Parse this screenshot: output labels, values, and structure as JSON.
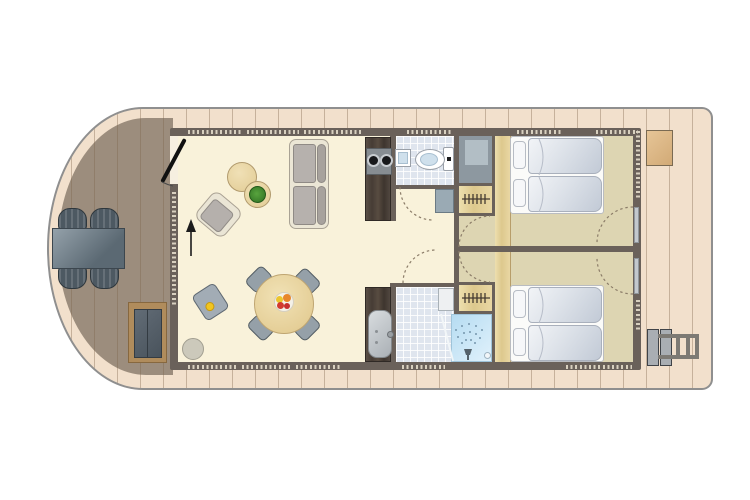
{
  "meta": {
    "title": "Houseboat floor plan (top view)",
    "kind": "architectural-floor-plan",
    "text_visible": "none"
  },
  "palette": {
    "hull": "#f2e0cc",
    "deck_plank_line": "#7d644b",
    "bow_terrace": "#9c8d7d",
    "wall": "#6a615a",
    "living_floor": "#f9f2da",
    "bedroom_floor": "#ddd5b2",
    "tile_floor": "#dfe5ee",
    "light_wood": "#e9d7a3",
    "dark_wood_counter": "#4d433c",
    "shower_blue": "#bfe0f3",
    "plant_green": "#3e8d2d",
    "furniture_slate": "#5b6973"
  },
  "rooms": [
    {
      "id": "bow-terrace",
      "name": "Bow terrace deck"
    },
    {
      "id": "living-room",
      "name": "Living room with lounge and dining area"
    },
    {
      "id": "kitchen",
      "name": "Kitchenette with 2-burner hob"
    },
    {
      "id": "toilet-room",
      "name": "Toilet room with corner hand basin"
    },
    {
      "id": "hallway",
      "name": "Central hallway"
    },
    {
      "id": "bathroom",
      "name": "Bathroom with vanity and walk-in shower"
    },
    {
      "id": "technical-room",
      "name": "Technical / storage room"
    },
    {
      "id": "bedroom-top",
      "name": "Bedroom 1 with two single beds and wardrobe"
    },
    {
      "id": "bedroom-bottom",
      "name": "Bedroom 2 with two single beds and wardrobe"
    },
    {
      "id": "stern-deck",
      "name": "Stern deck with storage box and swim ladder"
    }
  ],
  "furniture": [
    "outdoor dining table",
    "four outdoor chairs",
    "outdoor storage bench",
    "entrance door with swing",
    "entry direction arrow",
    "sofa",
    "armchair",
    "two round side tables",
    "potted plant",
    "round dining table with fruit bowl",
    "four dining chairs",
    "child high chair",
    "pouf",
    "kitchen counter",
    "two-burner cooktop",
    "corner hand basin",
    "toilet",
    "hall cabinet",
    "washbasin on vanity",
    "white appliance",
    "walk-in shower with rain head",
    "two wardrobes with hanging rails",
    "four single beds with pillows",
    "bedside wood shelf strips",
    "wooden deck storage box",
    "swim ladder"
  ],
  "openings": {
    "doors": [
      "entrance (bow wall)",
      "toilet room door",
      "bathroom door",
      "bedroom 1 hall door",
      "bedroom 2 hall door",
      "bedroom 1 stern door",
      "bedroom 2 stern door"
    ],
    "windows": [
      "living room front band",
      "living room top bands",
      "living room bottom bands",
      "toilet room top band",
      "bathroom bottom band",
      "bedroom 1 top bands",
      "bedroom 2 bottom band",
      "stern wall bands"
    ]
  }
}
